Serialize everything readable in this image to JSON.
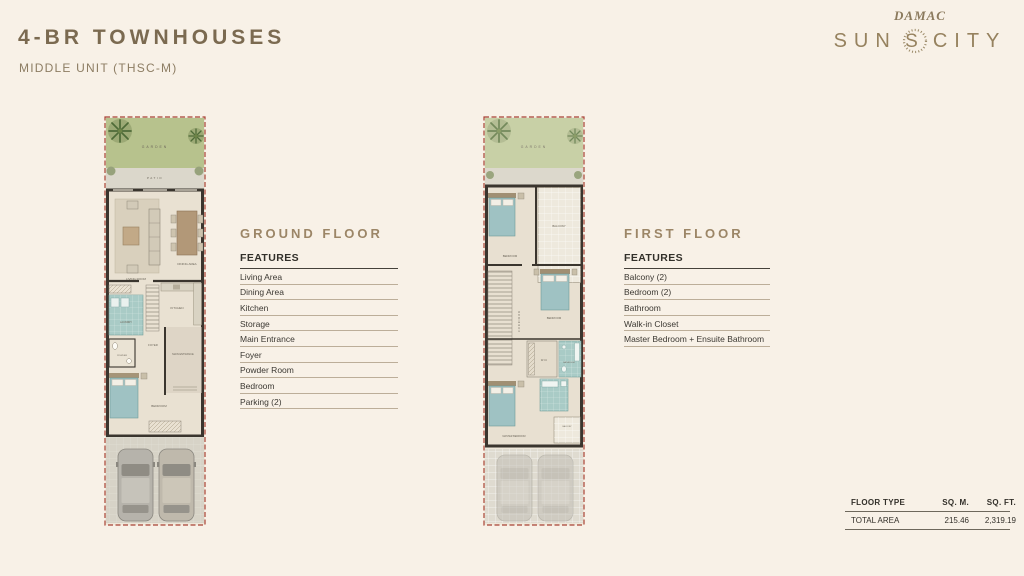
{
  "header": {
    "title": "4-BR TOWNHOUSES",
    "subtitle": "MIDDLE UNIT (THSC-M)"
  },
  "logo": {
    "brand": "DAMAC",
    "name_left": "SUN",
    "name_right": "CITY",
    "emblem": "S"
  },
  "ground_floor": {
    "heading": "GROUND FLOOR",
    "features_label": "FEATURES",
    "features": [
      "Living Area",
      "Dining Area",
      "Kitchen",
      "Storage",
      "Main Entrance",
      "Foyer",
      "Powder Room",
      "Bedroom",
      "Parking (2)"
    ],
    "plan_labels": {
      "garden": "GARDEN",
      "patio": "PATIO",
      "living": "LIVING ROOM",
      "dining": "DINING AREA",
      "kitchen": "KITCHEN",
      "laundry": "LAUNDRY",
      "foyer": "FOYER",
      "entrance": "MAIN ENTRANCE",
      "powder": "POWDER",
      "bedroom": "BEDROOM"
    }
  },
  "first_floor": {
    "heading": "FIRST FLOOR",
    "features_label": "FEATURES",
    "features": [
      "Balcony (2)",
      "Bedroom (2)",
      "Bathroom",
      "Walk-in Closet",
      "Master Bedroom + Ensuite Bathroom"
    ],
    "plan_labels": {
      "garden": "GARDEN",
      "balcony1": "BALCONY",
      "bedroom1": "BEDROOM",
      "corridor": "CORRIDOR",
      "bedroom2": "BEDROOM",
      "wic": "W.I.C",
      "bathroom": "BATHROOM",
      "master": "MASTER BEDROOM",
      "balcony2": "BALCONY"
    }
  },
  "area_table": {
    "col_floor_type": "FLOOR TYPE",
    "col_sqm": "SQ. M.",
    "col_sqft": "SQ. FT.",
    "row_label": "TOTAL AREA",
    "sqm": "215.46",
    "sqft": "2,319.19"
  },
  "colors": {
    "background": "#f8f1e7",
    "accent_gold": "#96825f",
    "heading_gold": "#9c8667",
    "wall_dark": "#3a352e",
    "floor": "#e9e1d2",
    "garden_green": "#b7c28d",
    "wet_area_teal": "#a9cbc6",
    "boundary_red": "#a84234",
    "text_dark": "#3b3832"
  }
}
